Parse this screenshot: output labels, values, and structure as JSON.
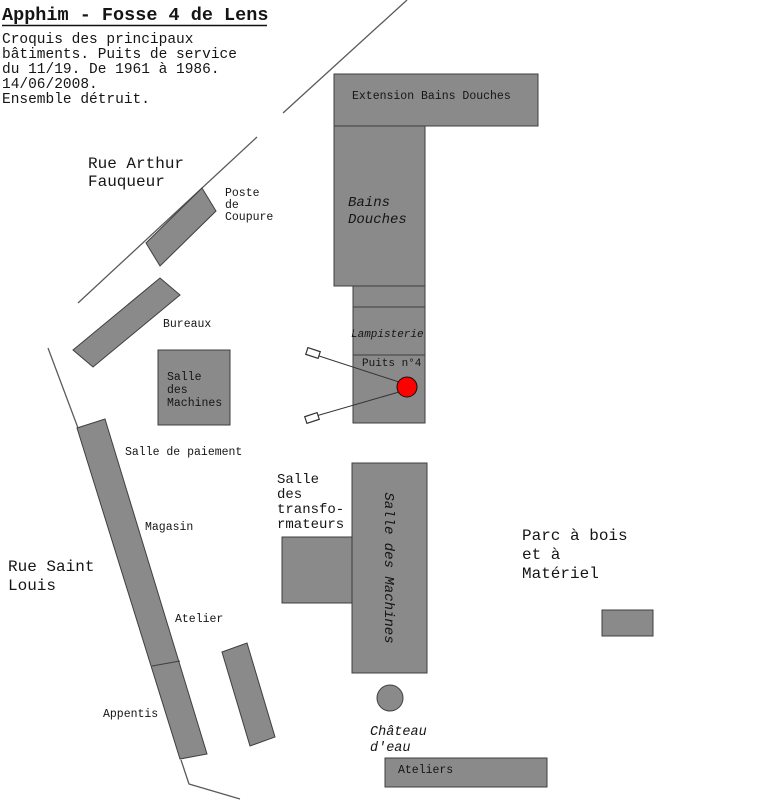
{
  "page": {
    "title": "Apphim - Fosse 4 de Lens",
    "notes_lines": [
      "Croquis des principaux",
      "bâtiments. Puits de service",
      "du 11/19. De 1961 à 1986.",
      "14/06/2008.",
      "Ensemble détruit."
    ]
  },
  "streets": {
    "rue_arthur_fauqueur": {
      "lines": [
        "Rue Arthur",
        "Fauqueur"
      ]
    },
    "rue_saint_louis": {
      "lines": [
        "Rue Saint",
        "Louis"
      ]
    },
    "parc_a_bois": {
      "lines": [
        "Parc à bois",
        "et à",
        "Matériel"
      ]
    }
  },
  "buildings": {
    "extension_bains_douches": {
      "label": "Extension Bains Douches"
    },
    "bains_douches": {
      "lines": [
        "Bains",
        "Douches"
      ]
    },
    "lampisterie": {
      "label": "Lampisterie"
    },
    "puits_n4": {
      "label": "Puits n°4"
    },
    "poste_de_coupure": {
      "lines": [
        "Poste",
        "de",
        "Coupure"
      ]
    },
    "bureaux": {
      "label": "Bureaux"
    },
    "salle_des_machines_small": {
      "lines": [
        "Salle",
        "des",
        "Machines"
      ]
    },
    "salle_de_paiement": {
      "label": "Salle de paiement"
    },
    "magasin": {
      "label": "Magasin"
    },
    "atelier": {
      "label": "Atelier"
    },
    "appentis": {
      "label": "Appentis"
    },
    "salle_des_transformateurs": {
      "lines": [
        "Salle",
        "des",
        "transfo-",
        "rmateurs"
      ]
    },
    "salle_des_machines_vertical": {
      "label": "Salle des Machines"
    },
    "chateau_deau": {
      "lines": [
        "Château",
        "d'eau"
      ]
    },
    "ateliers": {
      "label": "Ateliers"
    }
  },
  "colors": {
    "building_fill": "#8a8a8a",
    "building_stroke": "#3f3f3f",
    "road_stroke": "#5a5a5a",
    "shaft_red": "#ff0000"
  }
}
